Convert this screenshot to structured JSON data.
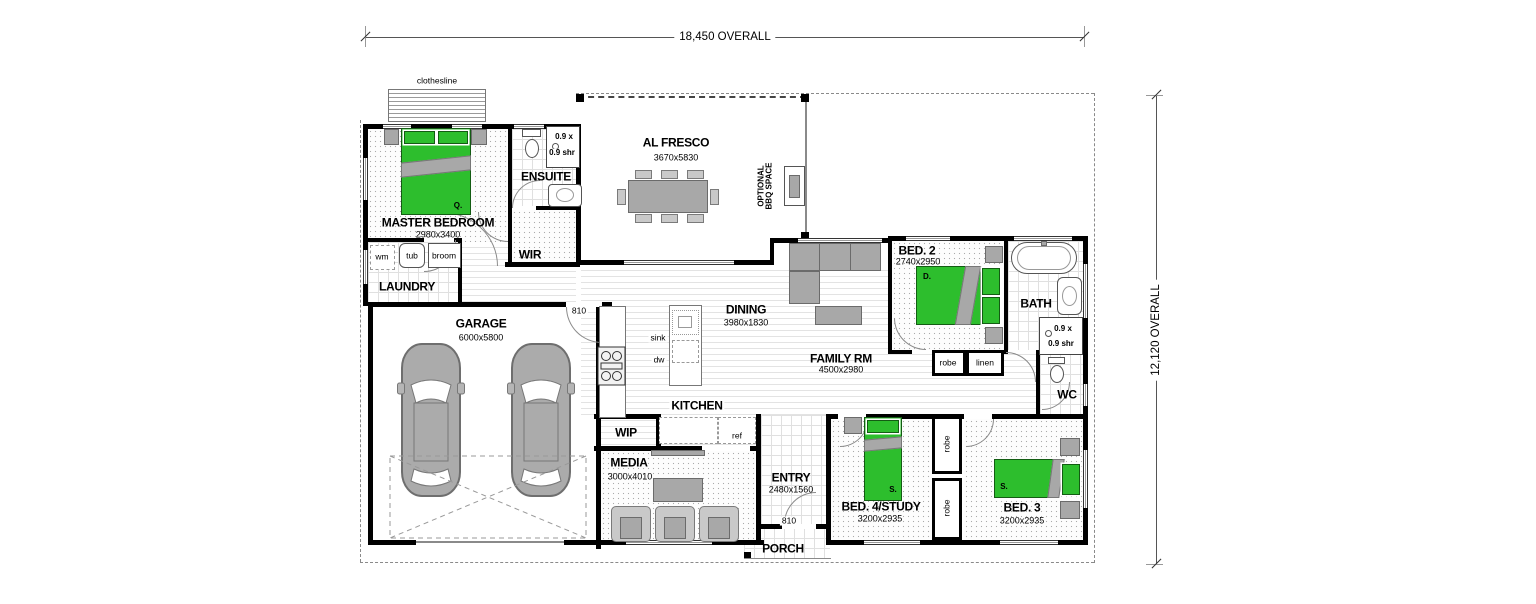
{
  "dims": {
    "width_overall": "18,450 OVERALL",
    "height_overall": "12,120 OVERALL"
  },
  "rooms": {
    "master": {
      "name": "MASTER BEDROOM",
      "size": "2980x3400"
    },
    "ensuite": {
      "name": "ENSUITE"
    },
    "wir": {
      "name": "WIR"
    },
    "laundry": {
      "name": "LAUNDRY"
    },
    "alfresco": {
      "name": "AL FRESCO",
      "size": "3670x5830"
    },
    "garage": {
      "name": "GARAGE",
      "size": "6000x5800"
    },
    "dining": {
      "name": "DINING",
      "size": "3980x1830"
    },
    "family": {
      "name": "FAMILY RM",
      "size": "4500x2980"
    },
    "kitchen": {
      "name": "KITCHEN"
    },
    "wip": {
      "name": "WIP"
    },
    "media": {
      "name": "MEDIA",
      "size": "3000x4010"
    },
    "entry": {
      "name": "ENTRY",
      "size": "2480x1560"
    },
    "porch": {
      "name": "PORCH"
    },
    "bed2": {
      "name": "BED. 2",
      "size": "2740x2950"
    },
    "bath": {
      "name": "BATH"
    },
    "wc": {
      "name": "WC"
    },
    "bed4": {
      "name": "BED. 4/STUDY",
      "size": "3200x2935"
    },
    "bed3": {
      "name": "BED. 3",
      "size": "3200x2935"
    }
  },
  "fixtures": {
    "clothesline": "clothesline",
    "wm": "wm",
    "tub": "tub",
    "broom": "broom",
    "sink": "sink",
    "dw": "dw",
    "ref": "ref",
    "robe": "robe",
    "linen": "linen",
    "shower_w": "0.9 x",
    "shower_d": "0.9 shr",
    "door_width": "810",
    "bbq_l1": "OPTIONAL",
    "bbq_l2": "BBQ SPACE",
    "bed_q": "Q.",
    "bed_d": "D.",
    "bed_s": "S."
  },
  "colors": {
    "bed_green": "#2dbe2d",
    "furniture_gray": "#a8a8a8",
    "wall_black": "#000000"
  }
}
